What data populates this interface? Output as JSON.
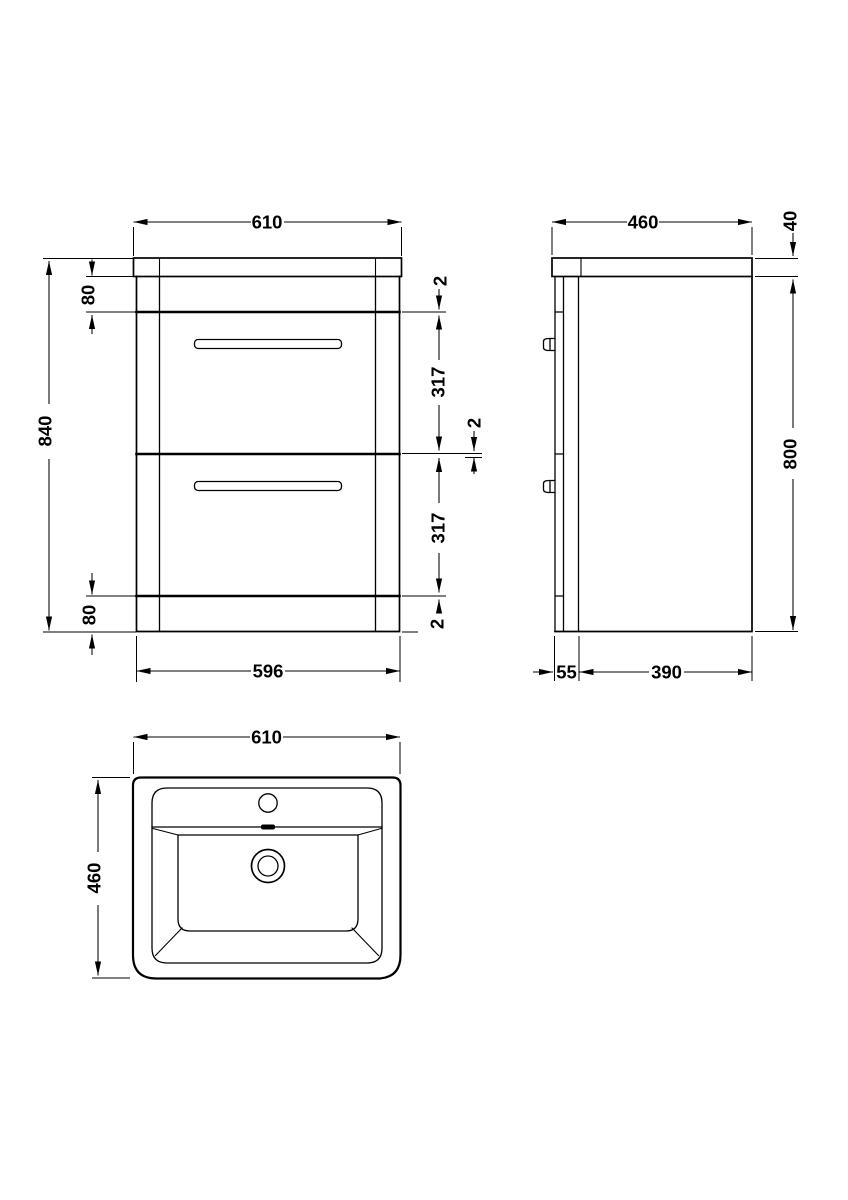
{
  "colors": {
    "line": "#000000",
    "background": "#ffffff"
  },
  "front_view": {
    "dims": {
      "width_top": "610",
      "overall_height": "840",
      "top_rail": "80",
      "gap_top": "2",
      "drawer_upper": "317",
      "gap_middle": "2",
      "drawer_lower": "317",
      "gap_bottom": "2",
      "bottom_rail": "80",
      "body_width": "596"
    }
  },
  "side_view": {
    "dims": {
      "depth_top": "460",
      "worktop_thickness": "40",
      "body_height": "800",
      "front_projection": "55",
      "body_depth": "390"
    }
  },
  "plan_view": {
    "dims": {
      "width": "610",
      "depth": "460"
    }
  }
}
